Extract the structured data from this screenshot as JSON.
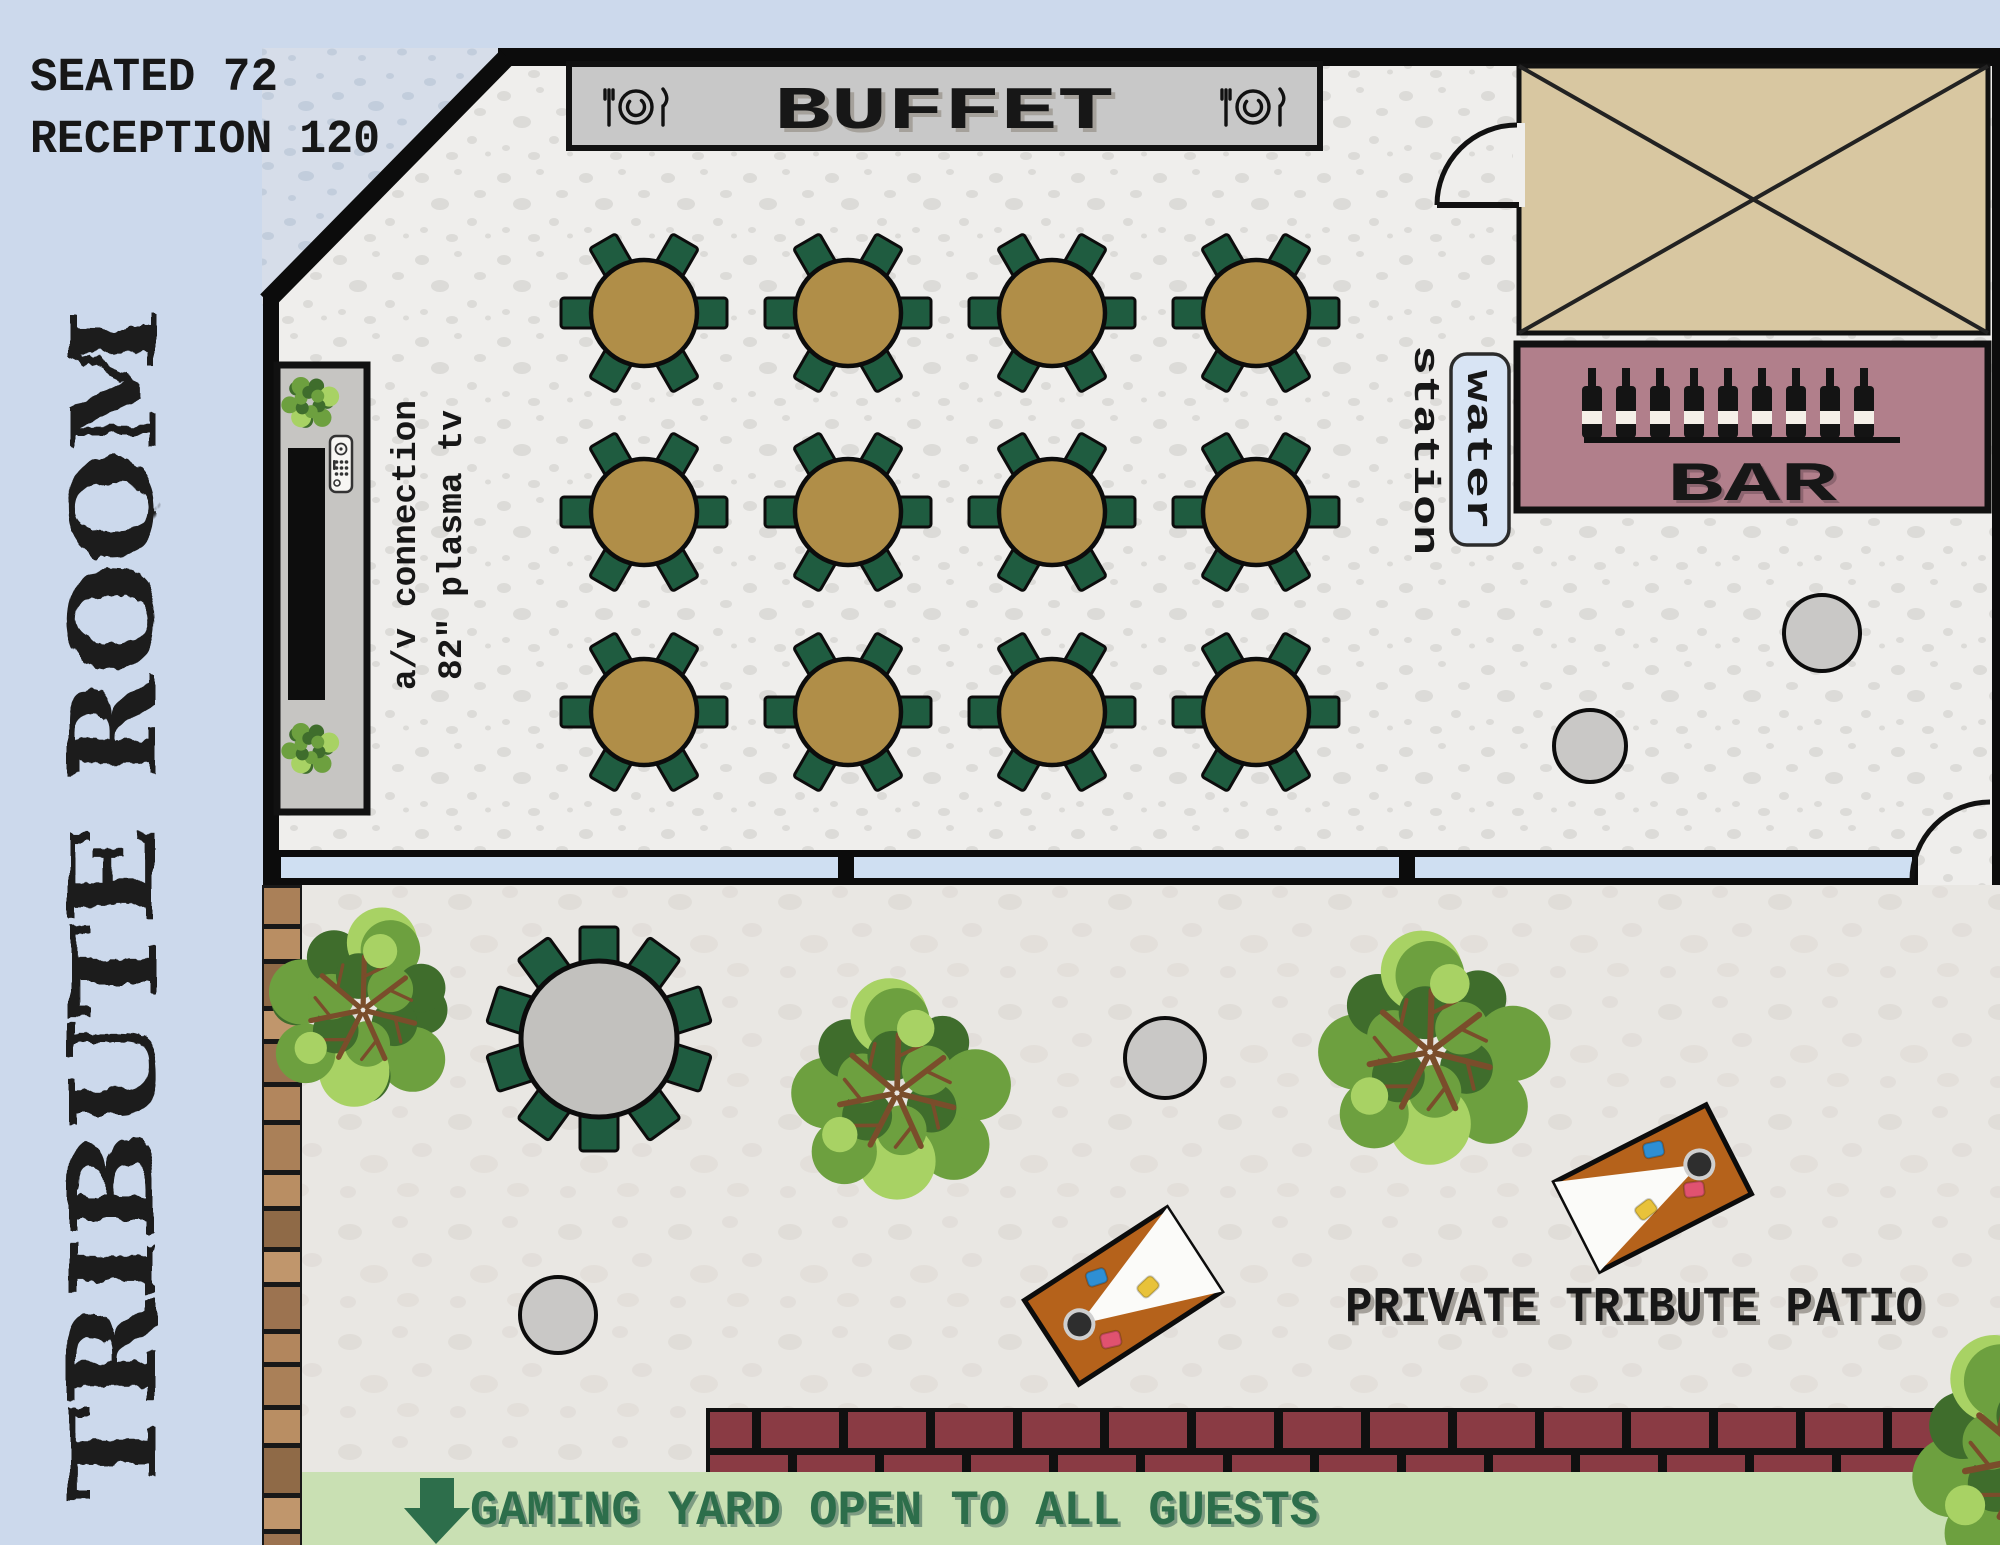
{
  "header": {
    "capacity_line1": "SEATED 72",
    "capacity_line2": "RECEPTION 120",
    "room_title_vertical": "TRIBUTE ROOM"
  },
  "room": {
    "buffet_label": "BUFFET",
    "bar_label": "BAR",
    "water_station_line1": "water",
    "water_station_line2": "station",
    "av_note_line1": "a/v connection",
    "av_note_line2": "82\" plasma tv",
    "dining_table_count": 12,
    "chairs_per_table": 6,
    "wine_bottle_count": 9
  },
  "patio": {
    "label": "PRIVATE TRIBUTE PATIO",
    "banner_text": "GAMING YARD OPEN TO ALL GUESTS",
    "patio_table_chair_count": 10,
    "cornhole_board_count": 2,
    "tree_count": 4
  },
  "colors": {
    "sidebar": "#ccd9ec",
    "room_floor": "#efeeec",
    "room_speck": "#dcdbd8",
    "exterior": "#d6dde9",
    "exterior_speck": "#c2cddc",
    "patio": "#e9e7e3",
    "patio_speck": "#ded9d3",
    "wall": "#0c0c0c",
    "window_glass": "#cfdff2",
    "buffet_bg": "#c8c8c8",
    "closet_tan": "#d8c7a1",
    "bar_bg": "#b17f8b",
    "bar_bottle": "#141414",
    "bottle_label": "#f5f0e8",
    "water_box": "#d8e4f4",
    "table_top": "#b08e48",
    "chair_green": "#1f5c40",
    "tv_wall": "#c6c5c2",
    "tv_black": "#0d0d0d",
    "remote_body": "#f7f6f3",
    "deck_gap": "#181818",
    "deck_browns": [
      "#aa8058",
      "#b98e63",
      "#8f6a47",
      "#c0966c",
      "#9c7350",
      "#b2865d"
    ],
    "brick": "#8a3b44",
    "brick_mortar": "#101010",
    "banner_bg": "#c9e0b3",
    "banner_green": "#2d6e4b",
    "banner_shadow": "#7d9b82",
    "board_orange": "#b5621b",
    "board_white": "#fbfbf9",
    "hole_dark": "#2e2e2e",
    "hole_ring": "#cfcfcf",
    "bag_blue": "#2e8fd4",
    "bag_yellow": "#e8c23a",
    "bag_pink": "#e05270",
    "cocktail_gray": "#c9c8c6",
    "patio_table_gray": "#c2c1be",
    "tree_dark": "#3f6d2c",
    "tree_mid": "#6da03f",
    "tree_light": "#a8d264",
    "branch": "#7a4d2b",
    "text_dark": "#171717",
    "shadow_gray": "#a5a19b"
  },
  "floorplan": {
    "canvas": {
      "w": 2000,
      "h": 1545
    },
    "dining_tables": {
      "col_x": [
        644,
        848,
        1052,
        1256
      ],
      "row_y": [
        313,
        512,
        712
      ],
      "table_radius": 53,
      "chair_angles": [
        0,
        60,
        120,
        180,
        240,
        300
      ]
    },
    "patio_table": {
      "cx": 599,
      "cy": 1039,
      "radius": 78,
      "chair_count": 10
    },
    "cocktail_tables": [
      {
        "cx": 1822,
        "cy": 633,
        "r": 38
      },
      {
        "cx": 1590,
        "cy": 746,
        "r": 36
      },
      {
        "cx": 1165,
        "cy": 1058,
        "r": 40
      },
      {
        "cx": 558,
        "cy": 1315,
        "r": 38
      }
    ],
    "trees": [
      {
        "cx": 363,
        "cy": 1010,
        "r": 95
      },
      {
        "cx": 897,
        "cy": 1093,
        "r": 104
      },
      {
        "cx": 1430,
        "cy": 1052,
        "r": 110
      },
      {
        "cx": 2030,
        "cy": 1458,
        "r": 118
      }
    ],
    "bushes": [
      {
        "cx": 310,
        "cy": 402,
        "r": 27
      },
      {
        "cx": 310,
        "cy": 748,
        "r": 27
      }
    ],
    "cornhole_boards": [
      {
        "cx": 1123,
        "cy": 1296,
        "rot": -33,
        "hole_side": "left"
      },
      {
        "cx": 1653,
        "cy": 1188,
        "rot": -27,
        "hole_side": "right"
      }
    ],
    "wine_bottles": {
      "count": 9,
      "x_start": 1592,
      "x_step": 34
    },
    "deck": {
      "x": 262,
      "w": 40,
      "y_top": 885,
      "y_bottom": 1545
    },
    "brick": {
      "x": 706,
      "y": 1408,
      "h": 64,
      "brick_w": 78,
      "gap": 9
    },
    "banner": {
      "x": 302,
      "y": 1472,
      "h": 73
    }
  }
}
